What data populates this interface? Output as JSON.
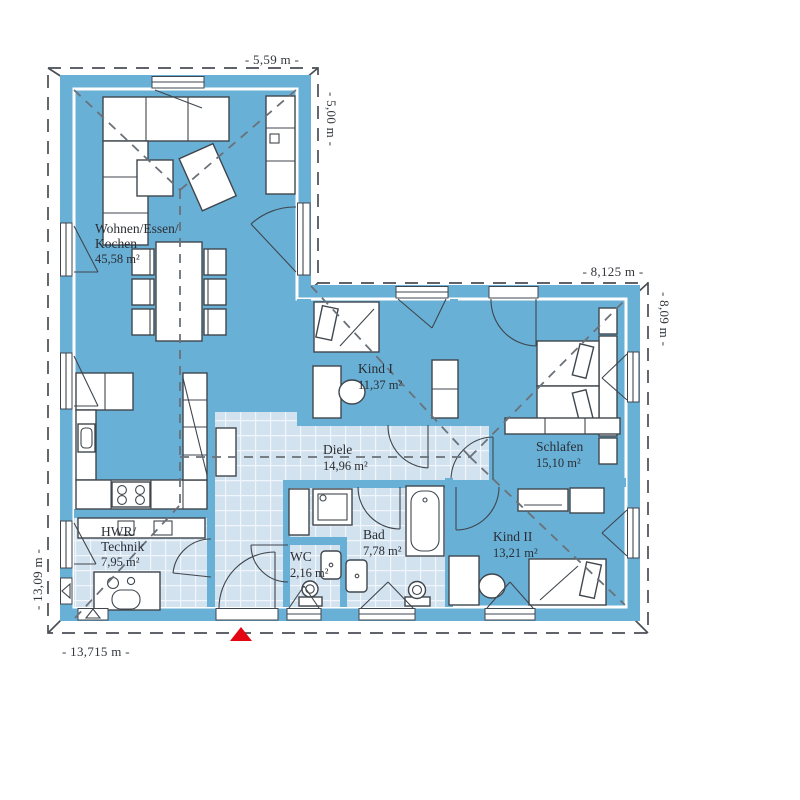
{
  "rooms": {
    "wohnen": {
      "line1": "Wohnen/Essen/",
      "line2": "Kochen",
      "area": "45,58 m²"
    },
    "kind1": {
      "name": "Kind I",
      "area": "11,37 m²"
    },
    "schlafen": {
      "name": "Schlafen",
      "area": "15,10 m²"
    },
    "diele": {
      "name": "Diele",
      "area": "14,96 m²"
    },
    "kind2": {
      "name": "Kind II",
      "area": "13,21 m²"
    },
    "bad": {
      "name": "Bad",
      "area": "7,78 m²"
    },
    "wc": {
      "name": "WC",
      "area": "2,16 m²"
    },
    "hwr": {
      "line1": "HWR/",
      "line2": "Technik",
      "area": "7,95 m²"
    }
  },
  "dimensions": {
    "top": "- 5,59 m -",
    "top_wing_right": "- 5,00 m -",
    "right_wing_top": "- 8,125 m -",
    "right": "- 8,09 m -",
    "left": "- 13,09 m -",
    "bottom": "- 13,715 m -"
  },
  "colors": {
    "wall": "#69b0d6",
    "room": "#dceaf5",
    "tile": "#d3e2ef",
    "accent": "#e30613",
    "line": "#3f464d",
    "dash": "#6a7178"
  },
  "icons": {
    "entrance_marker": "red-triangle-north"
  }
}
